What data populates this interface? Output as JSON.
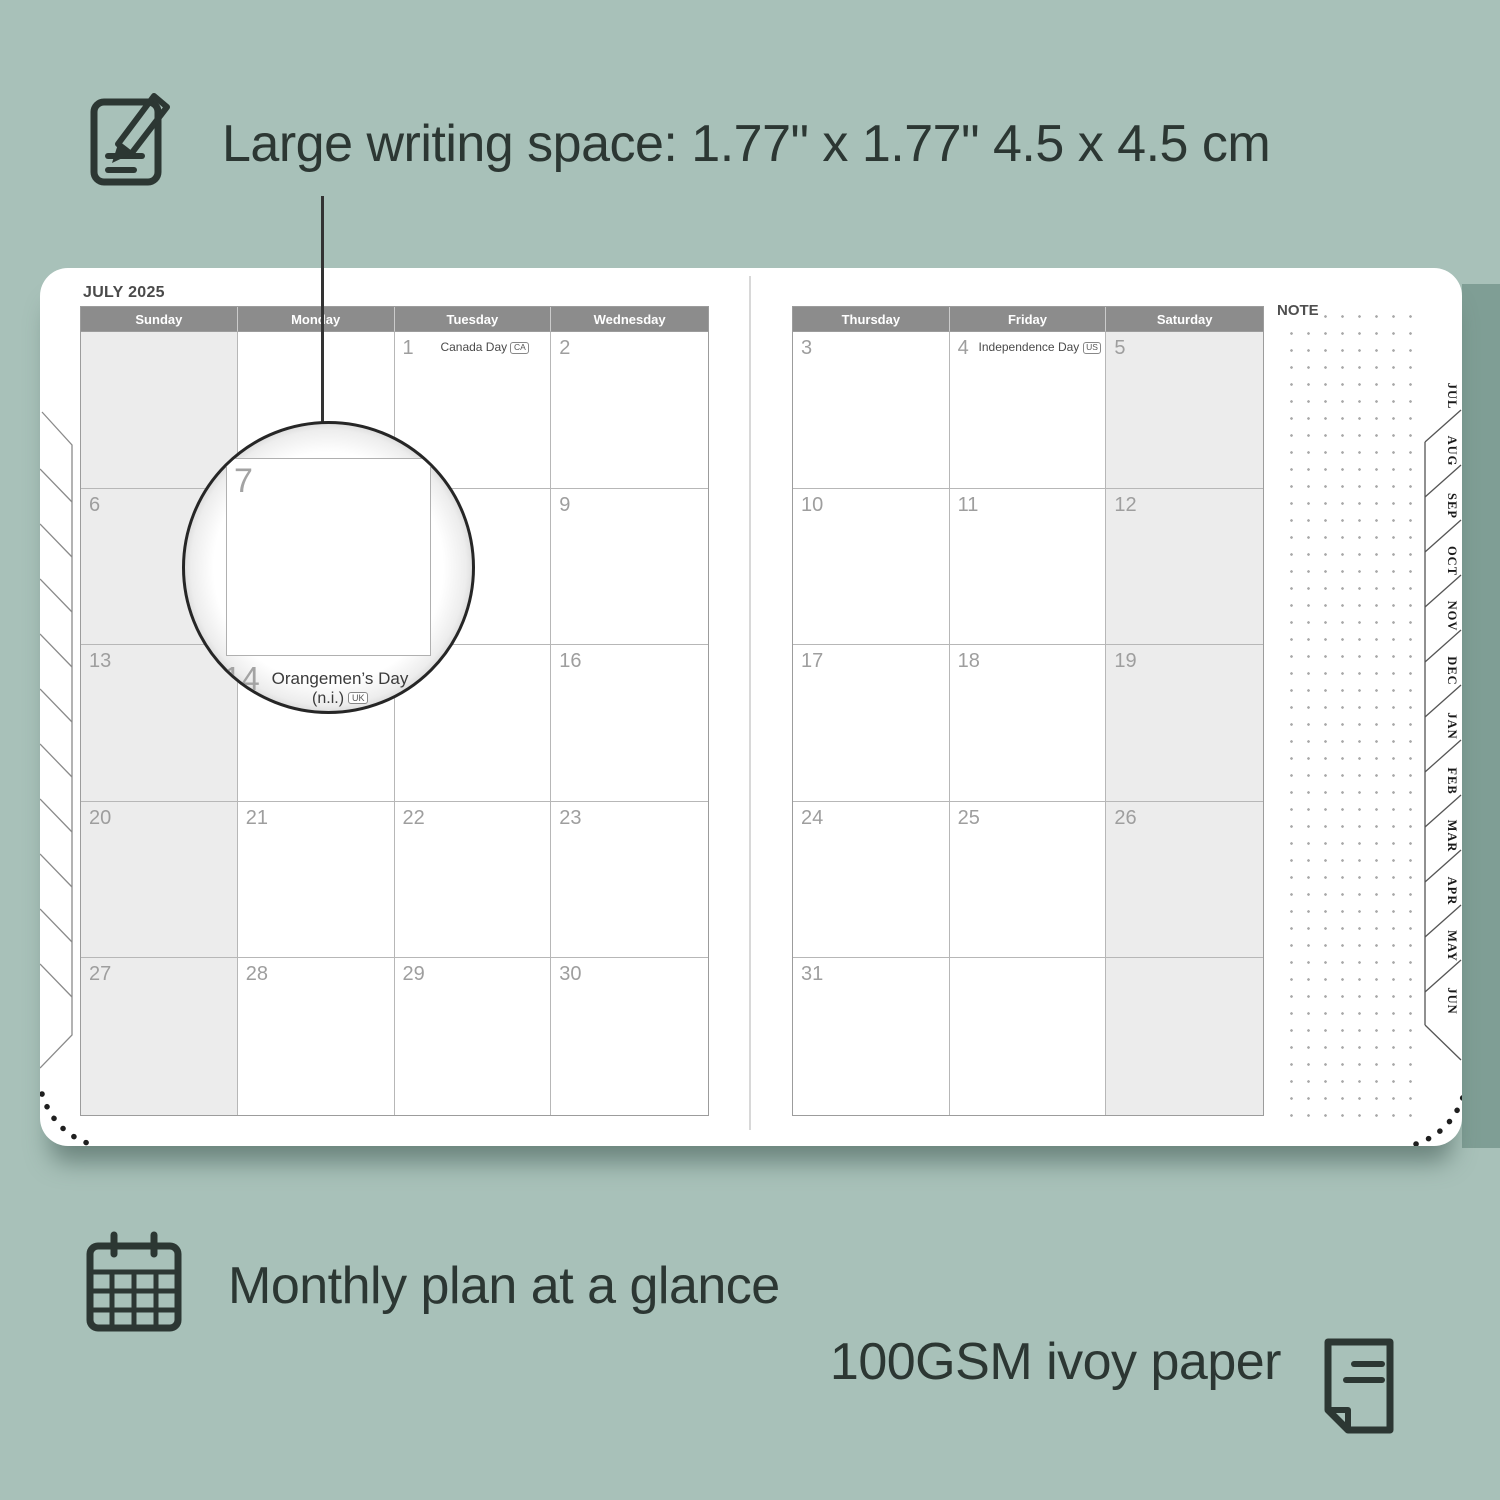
{
  "colors": {
    "background": "#a8c1b9",
    "background_shade_band": "#7f9e95",
    "ink": "#2c3733",
    "page": "#ffffff",
    "header_bg": "#8c8c8c",
    "header_text": "#ffffff",
    "shaded_column": "#ececec",
    "grid_line": "#b7b7b7",
    "day_number": "#9e9e9e",
    "title_text": "#4a4a4a"
  },
  "annotations": {
    "writing_space": {
      "label": "Large writing space: 1.77\" x 1.77\"  4.5 x 4.5 cm",
      "icon": "notepad-pencil-icon"
    },
    "monthly_plan": {
      "label": "Monthly plan at a glance",
      "icon": "calendar-grid-icon"
    },
    "paper": {
      "label": "100GSM ivoy paper",
      "icon": "paper-sheet-icon"
    }
  },
  "planner": {
    "month_title": "JULY 2025",
    "note_label": "NOTE",
    "left_page": {
      "headers": [
        "Sunday",
        "Monday",
        "Tuesday",
        "Wednesday"
      ],
      "shaded_column": 0,
      "rows": [
        [
          {
            "day": ""
          },
          {
            "day": ""
          },
          {
            "day": "1",
            "holiday": "Canada Day",
            "holiday_code": "CA"
          },
          {
            "day": "2"
          }
        ],
        [
          {
            "day": "6"
          },
          {
            "day": "7"
          },
          {
            "day": "8"
          },
          {
            "day": "9"
          }
        ],
        [
          {
            "day": "13"
          },
          {
            "day": "14",
            "holiday": "Orangemen’s Day (n.i.)",
            "holiday_code": "UK"
          },
          {
            "day": "15"
          },
          {
            "day": "16"
          }
        ],
        [
          {
            "day": "20"
          },
          {
            "day": "21"
          },
          {
            "day": "22"
          },
          {
            "day": "23"
          }
        ],
        [
          {
            "day": "27"
          },
          {
            "day": "28"
          },
          {
            "day": "29"
          },
          {
            "day": "30"
          }
        ]
      ]
    },
    "right_page": {
      "headers": [
        "Thursday",
        "Friday",
        "Saturday"
      ],
      "shaded_column": 2,
      "rows": [
        [
          {
            "day": "3"
          },
          {
            "day": "4",
            "holiday": "Independence Day",
            "holiday_code": "US"
          },
          {
            "day": "5"
          }
        ],
        [
          {
            "day": "10"
          },
          {
            "day": "11"
          },
          {
            "day": "12"
          }
        ],
        [
          {
            "day": "17"
          },
          {
            "day": "18"
          },
          {
            "day": "19"
          }
        ],
        [
          {
            "day": "24"
          },
          {
            "day": "25"
          },
          {
            "day": "26"
          }
        ],
        [
          {
            "day": "31"
          },
          {
            "day": ""
          },
          {
            "day": ""
          }
        ]
      ]
    },
    "month_tabs": [
      "JUL",
      "AUG",
      "SEP",
      "OCT",
      "NOV",
      "DEC",
      "JAN",
      "FEB",
      "MAR",
      "APR",
      "MAY",
      "JUN"
    ],
    "magnifier": {
      "day": "7",
      "clipped_next_day": "14",
      "holiday_line1": "Orangemen’s Day",
      "holiday_line2": "(n.i.)",
      "holiday_code": "UK"
    }
  }
}
